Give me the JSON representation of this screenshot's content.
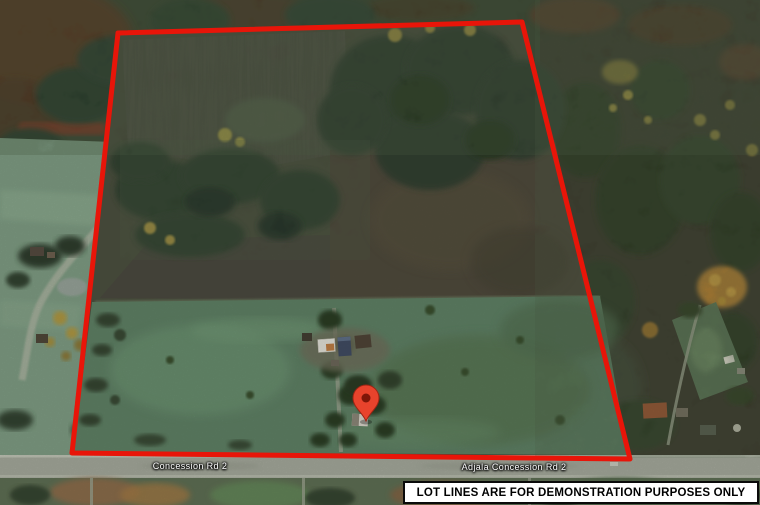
{
  "map": {
    "road_labels": [
      {
        "id": "west",
        "text": "Concession Rd 2"
      },
      {
        "id": "east",
        "text": "Adjala Concession Rd 2"
      }
    ],
    "marker": {
      "type": "red-location-pin"
    },
    "disclaimer": {
      "text": "LOT LINES ARE FOR DEMONSTRATION PURPOSES ONLY"
    },
    "colors": {
      "boundary": "#e81509",
      "pin": "#e8432c",
      "pin_dot": "#7e1608",
      "road_label": "#ffffff",
      "disclaimer_bg": "#ffffff",
      "disclaimer_border": "#0a0a0a",
      "disclaimer_text": "#000000"
    }
  }
}
